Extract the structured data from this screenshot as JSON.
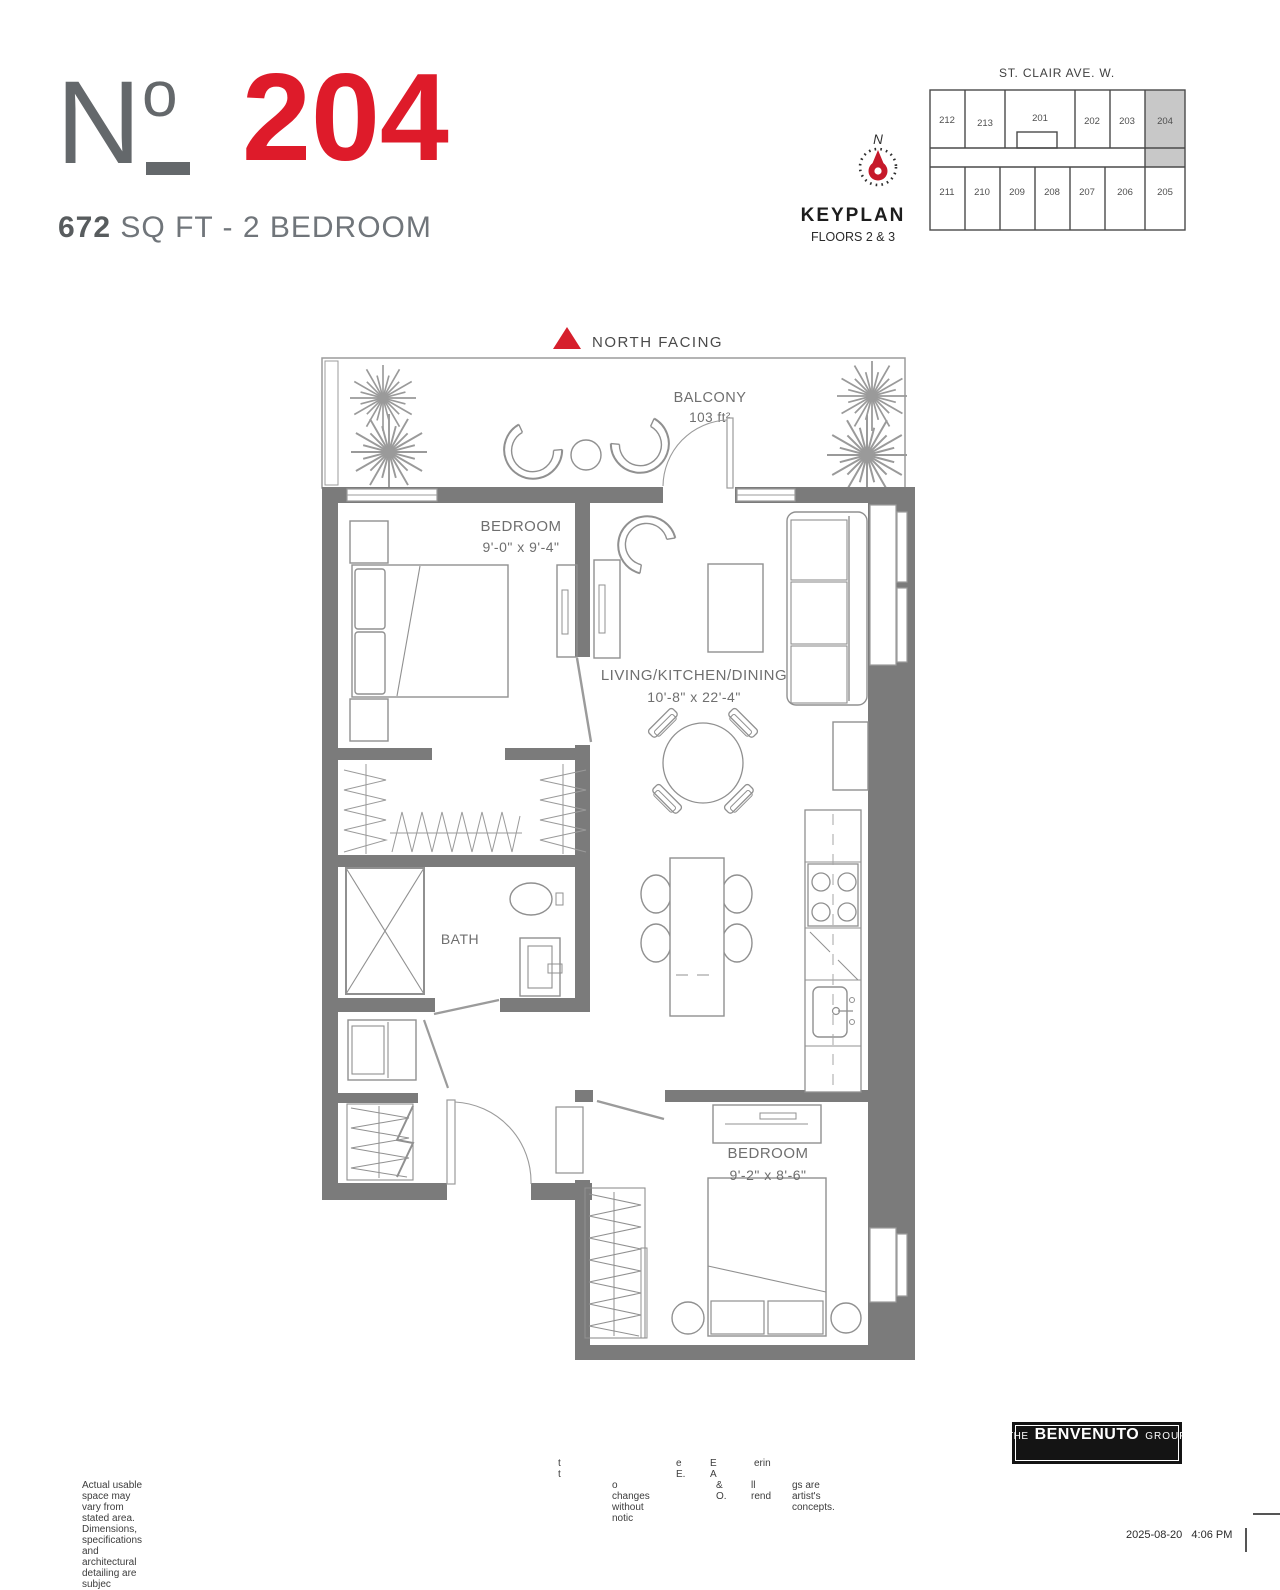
{
  "colors": {
    "accent_red": "#DE1B2A",
    "wall_gray": "#7B7B7B",
    "keyplan_highlight": "#C8C8C8"
  },
  "header": {
    "unit_prefix": "N",
    "unit_prefix_small": "o",
    "unit_number": "204",
    "area_value": "672",
    "area_rest": " SQ FT - 2 BEDROOM"
  },
  "keyplan": {
    "street": "ST. CLAIR AVE. W.",
    "north_label": "N",
    "title": "KEYPLAN",
    "subtitle": "FLOORS 2 & 3",
    "highlighted_unit": "204",
    "top_row": [
      "212",
      "213",
      "201",
      "202",
      "203",
      "204"
    ],
    "bottom_row": [
      "211",
      "210",
      "209",
      "208",
      "207",
      "206",
      "205"
    ]
  },
  "plan": {
    "north_facing": "NORTH FACING",
    "balcony_label": "BALCONY",
    "balcony_area": "103 ft²",
    "bedroom1_label": "BEDROOM",
    "bedroom1_dims": "9'-0\" x 9'-4\"",
    "living_label": "LIVING/KITCHEN/DINING",
    "living_dims": "10'-8\" x 22'-4\"",
    "bath_label": "BATH",
    "bedroom2_label": "BEDROOM",
    "bedroom2_dims": "9'-2\" x 8'-6\""
  },
  "footer": {
    "frag1": "t t",
    "frag2": "e E.",
    "frag3": "E A",
    "frag4": "erin",
    "disc1": "Actual usable space may vary from stated area. Dimensions, specifications and architectural detailing are subjec",
    "disc2": "o changes without notic",
    "disc3": "& O.",
    "disc4": "ll rend",
    "disc5": "gs are artist's concepts.",
    "brand_the": "THE",
    "brand_name": "BENVENUTO",
    "brand_group": "GROUP",
    "timestamp": "2025-08-20   4:06 PM"
  }
}
